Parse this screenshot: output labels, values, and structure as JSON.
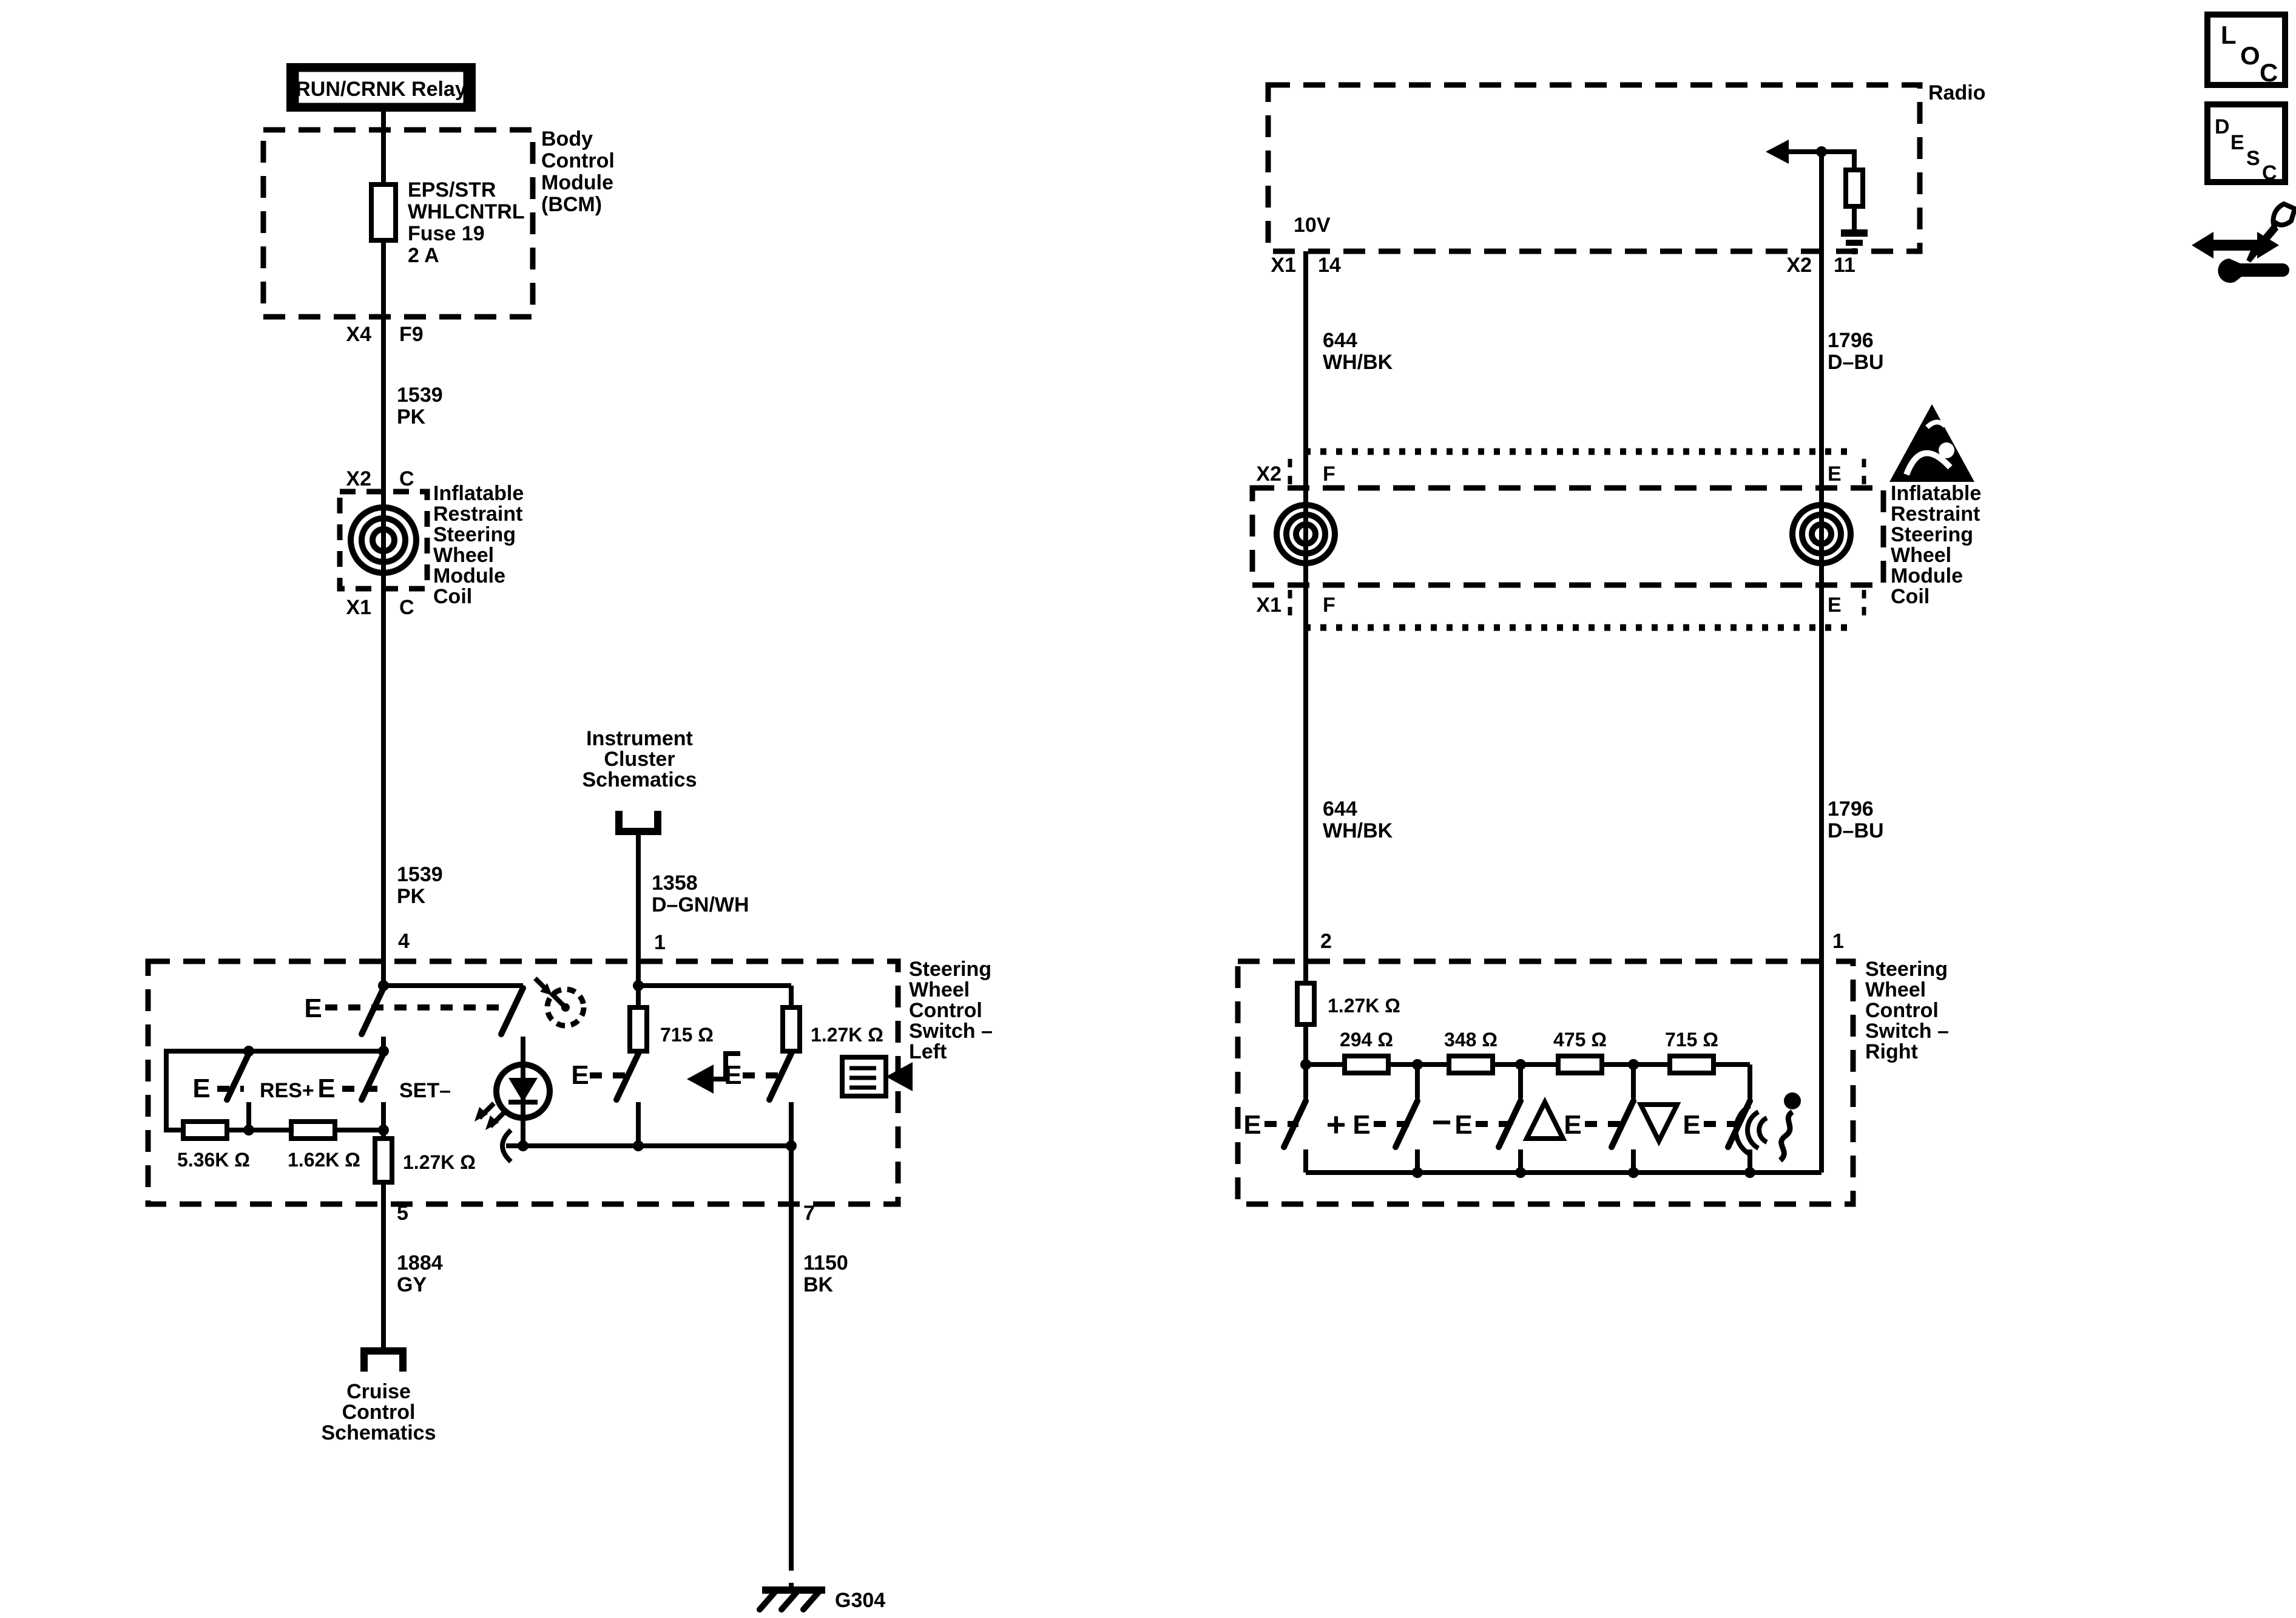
{
  "colors": {
    "ink": "#000000",
    "paper": "#ffffff"
  },
  "legend": {
    "loc": [
      "L",
      "O",
      "C"
    ],
    "desc": [
      "D",
      "E",
      "S",
      "C"
    ]
  },
  "bcm": {
    "relay": "RUN/CRNK Relay",
    "module": [
      "Body",
      "Control",
      "Module",
      "(BCM)"
    ],
    "fuse": [
      "EPS/STR",
      "WHLCNTRL",
      "Fuse 19",
      "2 A"
    ],
    "conn_top": "X4",
    "pin_top": "F9"
  },
  "left_circuit": {
    "wire_a": [
      "1539",
      "PK"
    ],
    "coil_conn_top": {
      "conn": "X2",
      "pin": "C"
    },
    "coil_label": [
      "Inflatable",
      "Restraint",
      "Steering",
      "Wheel",
      "Module",
      "Coil"
    ],
    "coil_conn_bot": {
      "conn": "X1",
      "pin": "C"
    },
    "wire_b": [
      "1539",
      "PK"
    ],
    "pin_in": "4",
    "instrument_ref": [
      "Instrument",
      "Cluster",
      "Schematics"
    ],
    "wire_1358": [
      "1358",
      "D–GN/WH"
    ],
    "pin_lamp": "1",
    "box_label": [
      "Steering",
      "Wheel",
      "Control",
      "Switch –",
      "Left"
    ],
    "switch_e": "E",
    "res_plus": "RES+",
    "set_minus": "SET–",
    "r1": "5.36K Ω",
    "r2": "1.62K Ω",
    "r3": "1.27K Ω",
    "r4": "715 Ω",
    "r5": "1.27K Ω",
    "pin_out_cruise": "5",
    "wire_1884": [
      "1884",
      "GY"
    ],
    "cruise_ref": [
      "Cruise",
      "Control",
      "Schematics"
    ],
    "pin_out_gnd": "7",
    "wire_1150": [
      "1150",
      "BK"
    ],
    "ground": "G304"
  },
  "right_circuit": {
    "radio": "Radio",
    "supply": "10V",
    "conn_left": {
      "conn": "X1",
      "pin": "14"
    },
    "conn_right": {
      "conn": "X2",
      "pin": "11"
    },
    "wire_left": [
      "644",
      "WH/BK"
    ],
    "wire_right": [
      "1796",
      "D–BU"
    ],
    "coil_conn_top": {
      "conn": "X2",
      "pin_l": "F",
      "pin_r": "E"
    },
    "coil_conn_bot": {
      "conn": "X1",
      "pin_l": "F",
      "pin_r": "E"
    },
    "coil_label": [
      "Inflatable",
      "Restraint",
      "Steering",
      "Wheel",
      "Module",
      "Coil"
    ],
    "pin_left": "2",
    "pin_right": "1",
    "box_label": [
      "Steering",
      "Wheel",
      "Control",
      "Switch –",
      "Right"
    ],
    "switch_e": "E",
    "r_base": "1.27K Ω",
    "r1": "294 Ω",
    "r2": "348 Ω",
    "r3": "475 Ω",
    "r4": "715 Ω",
    "plus": "+",
    "minus": "−"
  }
}
